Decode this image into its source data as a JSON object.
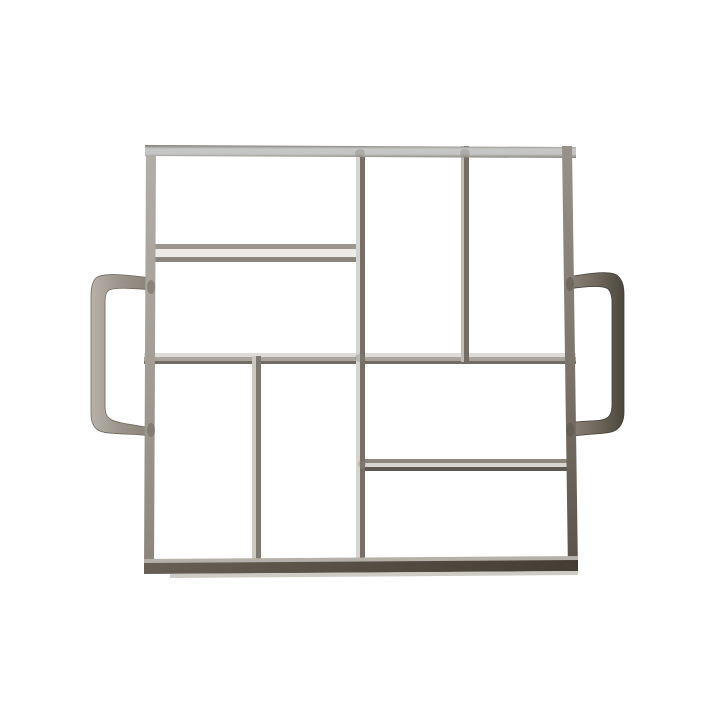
{
  "subject": {
    "type": "product-photo",
    "item": "Square welded steel paver mold with 8 rectangular cavities in a pinwheel pattern and two flat strap side handles",
    "cavities": 8,
    "handles": 2,
    "background_color": "#ffffff"
  },
  "palette": {
    "background": "#ffffff",
    "metal_light_face": "#c7c9c8",
    "metal_mid": "#9c958c",
    "metal_dark": "#4c463d",
    "divider_highlight": "#edebe8",
    "divider_shadow": "#736c64",
    "left_handle_tone": "#9c958c",
    "right_handle_tone": "#6e665b"
  },
  "svg": {
    "viewBox": "0 0 720 720",
    "gradients": [
      {
        "id": "g-top-rail",
        "x1": "0",
        "y1": "0",
        "x2": "0",
        "y2": "1",
        "stops": [
          {
            "offset": "0",
            "color": "#7e7973"
          },
          {
            "offset": "0.3",
            "color": "#c6c8c7"
          },
          {
            "offset": "0.7",
            "color": "#c3c4c3"
          },
          {
            "offset": "1",
            "color": "#878379"
          }
        ]
      },
      {
        "id": "g-left-rail",
        "x1": "0",
        "y1": "0",
        "x2": "0",
        "y2": "1",
        "stops": [
          {
            "offset": "0",
            "color": "#b3aea7"
          },
          {
            "offset": "0.5",
            "color": "#a49e97"
          },
          {
            "offset": "1",
            "color": "#8b847b"
          }
        ]
      },
      {
        "id": "g-right-rail",
        "x1": "0",
        "y1": "0",
        "x2": "0",
        "y2": "1",
        "stops": [
          {
            "offset": "0",
            "color": "#98918a"
          },
          {
            "offset": "0.5",
            "color": "#7d766d"
          },
          {
            "offset": "1",
            "color": "#5a5248"
          }
        ]
      },
      {
        "id": "g-bottom-rail",
        "x1": "0",
        "y1": "0",
        "x2": "1",
        "y2": "0",
        "stops": [
          {
            "offset": "0",
            "color": "#685f54"
          },
          {
            "offset": "1",
            "color": "#443d33"
          }
        ]
      },
      {
        "id": "g-left-handle",
        "x1": "0",
        "y1": "0",
        "x2": "1",
        "y2": "0",
        "stops": [
          {
            "offset": "0",
            "color": "#b7b2ab"
          },
          {
            "offset": "0.45",
            "color": "#9c958c"
          },
          {
            "offset": "1",
            "color": "#8a8279"
          }
        ]
      },
      {
        "id": "g-right-handle",
        "x1": "0",
        "y1": "0",
        "x2": "1",
        "y2": "0",
        "stops": [
          {
            "offset": "0",
            "color": "#8d857a"
          },
          {
            "offset": "0.55",
            "color": "#6e665b"
          },
          {
            "offset": "1",
            "color": "#4c463d"
          }
        ]
      }
    ],
    "shapes": [
      {
        "name": "divider-h1-top-edge",
        "type": "rect",
        "attrs": {
          "x": 146,
          "y": 244,
          "width": 219,
          "height": 5,
          "fill": "#9b958e"
        }
      },
      {
        "name": "divider-h1-face",
        "type": "rect",
        "attrs": {
          "x": 146,
          "y": 249,
          "width": 219,
          "height": 8,
          "fill": "#edebe8"
        }
      },
      {
        "name": "divider-h1-bottom-edge",
        "type": "rect",
        "attrs": {
          "x": 146,
          "y": 257,
          "width": 219,
          "height": 5,
          "fill": "#8b857d"
        }
      },
      {
        "name": "divider-h2-top-edge",
        "type": "rect",
        "attrs": {
          "x": 144,
          "y": 353,
          "width": 432,
          "height": 4,
          "fill": "#dedcd8"
        }
      },
      {
        "name": "divider-h2-face",
        "type": "rect",
        "attrs": {
          "x": 144,
          "y": 357,
          "width": 432,
          "height": 4,
          "fill": "#a9a49d"
        }
      },
      {
        "name": "divider-h2-bottom-edge",
        "type": "rect",
        "attrs": {
          "x": 144,
          "y": 361,
          "width": 432,
          "height": 3,
          "fill": "#736c64"
        }
      },
      {
        "name": "divider-h3-top-edge",
        "type": "rect",
        "attrs": {
          "x": 358,
          "y": 459,
          "width": 218,
          "height": 4,
          "fill": "#8d867d"
        }
      },
      {
        "name": "divider-h3-face",
        "type": "rect",
        "attrs": {
          "x": 358,
          "y": 463,
          "width": 218,
          "height": 4,
          "fill": "#d9d6d1"
        }
      },
      {
        "name": "divider-h3-bottom-edge",
        "type": "rect",
        "attrs": {
          "x": 358,
          "y": 467,
          "width": 218,
          "height": 4,
          "fill": "#5f5850"
        }
      },
      {
        "name": "divider-v1-light-edge",
        "type": "rect",
        "attrs": {
          "x": 356,
          "y": 146,
          "width": 4,
          "height": 424,
          "fill": "#d6d4d0"
        }
      },
      {
        "name": "divider-v1-dark-edge",
        "type": "rect",
        "attrs": {
          "x": 360,
          "y": 146,
          "width": 5,
          "height": 424,
          "fill": "#776f67"
        }
      },
      {
        "name": "divider-v2-light-edge",
        "type": "rect",
        "attrs": {
          "x": 461,
          "y": 146,
          "width": 3,
          "height": 216,
          "fill": "#c0bbb4"
        }
      },
      {
        "name": "divider-v2-dark-edge",
        "type": "rect",
        "attrs": {
          "x": 464,
          "y": 146,
          "width": 5,
          "height": 216,
          "fill": "#746d65"
        }
      },
      {
        "name": "divider-v3-light-edge",
        "type": "rect",
        "attrs": {
          "x": 252,
          "y": 356,
          "width": 4,
          "height": 214,
          "fill": "#cbc7c1"
        }
      },
      {
        "name": "divider-v3-dark-edge",
        "type": "rect",
        "attrs": {
          "x": 256,
          "y": 356,
          "width": 5,
          "height": 214,
          "fill": "#7e7970"
        }
      },
      {
        "name": "left-handle",
        "type": "path",
        "attrs": {
          "d": "M152,278 C128,275 103,272 96,278 C92,282 91,288 91,296 L91,413 C91,421 93,427 98,430 C105,435 130,433 152,436 Z M152,290 C130,288 112,287 108,291 C105,294 105,299 105,305 L105,405 C105,412 106,416 110,419 C116,423 134,425 152,428 Z",
          "fill": "url(#g-left-handle)",
          "fill-rule": "evenodd",
          "stroke": "#6f6860",
          "stroke-width": "0.8"
        }
      },
      {
        "name": "right-handle",
        "type": "path",
        "attrs": {
          "d": "M568,277 C590,273 612,270 618,276 C623,281 624,287 624,295 L624,412 C624,420 622,426 616,430 C608,435 588,433 568,437 Z M568,289 C588,286 603,285 608,289 C611,292 612,297 612,303 L612,404 C612,411 611,415 607,418 C601,422 586,420 568,423 Z",
          "fill": "url(#g-right-handle)",
          "fill-rule": "evenodd",
          "stroke": "#45403a",
          "stroke-width": "0.8"
        }
      },
      {
        "name": "frame-left-rail",
        "type": "polygon",
        "attrs": {
          "points": "146,145 156,145 154,572 144,572",
          "fill": "url(#g-left-rail)"
        }
      },
      {
        "name": "frame-top-rail",
        "type": "polygon",
        "attrs": {
          "points": "145,145 576,147 576,158 145,156",
          "fill": "url(#g-top-rail)"
        }
      },
      {
        "name": "frame-right-rail",
        "type": "polygon",
        "attrs": {
          "points": "562,146 572,146 578,571 568,571",
          "fill": "url(#g-right-rail)"
        }
      },
      {
        "name": "frame-bottom-rail-top-edge",
        "type": "polygon",
        "attrs": {
          "points": "144,559 578,556 578,561 144,564",
          "fill": "#b5b0a9"
        }
      },
      {
        "name": "frame-bottom-rail-face",
        "type": "polygon",
        "attrs": {
          "points": "144,563 578,560 578,571 144,574",
          "fill": "url(#g-bottom-rail)"
        }
      },
      {
        "name": "frame-bottom-rail-reflection",
        "type": "polygon",
        "attrs": {
          "points": "170,574 578,571 578,575 170,578",
          "fill": "#c6c2bb",
          "opacity": "0.85"
        }
      },
      {
        "name": "weld-mark-left-handle-top",
        "type": "ellipse",
        "attrs": {
          "cx": 151,
          "cy": 287,
          "rx": 4,
          "ry": 7,
          "fill": "#6b645b",
          "opacity": "0.5"
        }
      },
      {
        "name": "weld-mark-left-handle-bottom",
        "type": "ellipse",
        "attrs": {
          "cx": 151,
          "cy": 430,
          "rx": 4,
          "ry": 7,
          "fill": "#6b645b",
          "opacity": "0.5"
        }
      },
      {
        "name": "weld-mark-right-handle-top",
        "type": "ellipse",
        "attrs": {
          "cx": 570,
          "cy": 284,
          "rx": 4,
          "ry": 7,
          "fill": "#57514a",
          "opacity": "0.5"
        }
      },
      {
        "name": "weld-mark-right-handle-bottom",
        "type": "ellipse",
        "attrs": {
          "cx": 570,
          "cy": 430,
          "rx": 4,
          "ry": 7,
          "fill": "#57514a",
          "opacity": "0.5"
        }
      },
      {
        "name": "weld-mark-joint-top-v1",
        "type": "ellipse",
        "attrs": {
          "cx": 360,
          "cy": 153,
          "rx": 5,
          "ry": 4,
          "fill": "#8a857e",
          "opacity": "0.4"
        }
      },
      {
        "name": "weld-mark-joint-top-v2",
        "type": "ellipse",
        "attrs": {
          "cx": 465,
          "cy": 153,
          "rx": 5,
          "ry": 4,
          "fill": "#8a857e",
          "opacity": "0.4"
        }
      },
      {
        "name": "weld-mark-joint-center",
        "type": "ellipse",
        "attrs": {
          "cx": 360,
          "cy": 358,
          "rx": 5,
          "ry": 4,
          "fill": "#8a857e",
          "opacity": "0.35"
        }
      },
      {
        "name": "weld-mark-joint-h3",
        "type": "ellipse",
        "attrs": {
          "cx": 362,
          "cy": 464,
          "rx": 4,
          "ry": 4,
          "fill": "#8a857e",
          "opacity": "0.35"
        }
      }
    ]
  }
}
